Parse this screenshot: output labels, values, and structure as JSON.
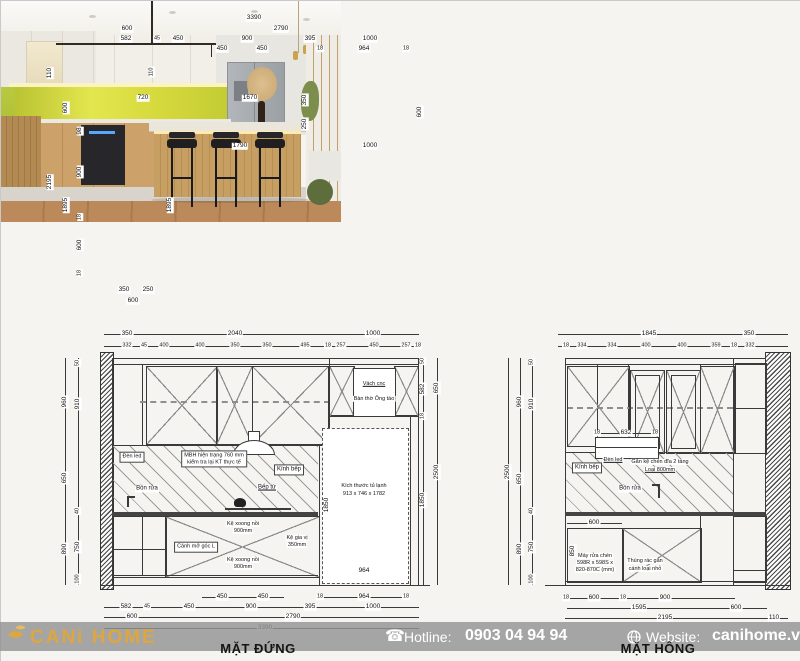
{
  "plan": {
    "top1": [
      "3390"
    ],
    "top2": [
      "600",
      "2790"
    ],
    "top3": [
      "582",
      "45",
      "450",
      "900",
      "395",
      "1000"
    ],
    "top4": [
      "450",
      "450",
      "18",
      "964",
      "18"
    ],
    "left1": [
      "110",
      "2195"
    ],
    "left2": [
      "600",
      "1895"
    ],
    "left3": [
      "98",
      "900",
      "18",
      "600",
      "18"
    ],
    "inner": [
      "720",
      "110",
      "1670",
      "350",
      "250",
      "1790",
      "1000",
      "1895",
      "600"
    ],
    "bottom": [
      "350",
      "250",
      "600"
    ]
  },
  "notes": {
    "title": "KHÁCH BẾP",
    "heading": "GHI CHÚ :",
    "bullet": "-",
    "note1": "Kiểm tra kích thước thực tế trước khi thi công",
    "note2": "Kết hợp xem ảnh thực tế và bản vẽ sản xuất",
    "subtitle": "CHI TIẾT BẾP L + TỦ LẠNH"
  },
  "front": {
    "title": "MẶT ĐỨNG",
    "top1": [
      "350",
      "2040",
      "1000"
    ],
    "top2": [
      "332",
      "45",
      "400",
      "400",
      "350",
      "350",
      "495",
      "18",
      "257",
      "450",
      "257",
      "18"
    ],
    "left1": [
      "960",
      "650",
      "890"
    ],
    "left2": [
      "50",
      "910",
      "40",
      "750",
      "100"
    ],
    "right1": [
      "50",
      "582",
      "18",
      "1850"
    ],
    "right2": [
      "650",
      "2500"
    ],
    "bottom1": [
      "450",
      "450",
      "18",
      "964",
      "18"
    ],
    "bottom2": [
      "582",
      "45",
      "450",
      "900",
      "395",
      "1000"
    ],
    "bottom3": [
      "600",
      "2790"
    ],
    "bottom4": [
      "3390"
    ],
    "labels": {
      "vach": "Vách cnc",
      "bantho": "Bàn thờ Ông táo",
      "denled": "Đèn led",
      "mbh1": "MBH hiện trạng 760 mm",
      "mbh2": "kiểm tra lại KT thực tế",
      "kinhbep": "Kính bếp",
      "beptu": "Bếp từ",
      "bonrua": "Bồn rửa",
      "canhmo": "Cánh mở góc L",
      "kexoong1": "Kệ xoong nồi",
      "kexoong2": "900mm",
      "kegiavi1": "Kệ gia vị",
      "kegiavi2": "350mm",
      "tulanh1": "Kích thước tủ lạnh",
      "tulanh2": "913 x 746 x 1782",
      "d1850": "1850",
      "d964": "964"
    }
  },
  "side": {
    "title": "MẶT HÔNG",
    "top1": [
      "1845",
      "350"
    ],
    "top2": [
      "18",
      "334",
      "334",
      "400",
      "400",
      "359",
      "18",
      "332"
    ],
    "left1": [
      "2500"
    ],
    "left2": [
      "960",
      "650",
      "890"
    ],
    "left3": [
      "50",
      "910",
      "40",
      "750",
      "100"
    ],
    "shelf": [
      "18",
      "632",
      "18"
    ],
    "bottom1": [
      "18",
      "600",
      "18",
      "900"
    ],
    "bottom2": [
      "1595",
      "600"
    ],
    "bottom3": [
      "2195",
      "110"
    ],
    "labels": {
      "kinhbep": "Kính bếp",
      "denled": "Đèn led",
      "kechen1": "Gắn kệ chén đĩa 2 tầng",
      "kechen2": "Loại 800mm",
      "bonrua": "Bồn rửa",
      "d600": "600",
      "d850": "850",
      "mayrua1": "Máy rửa chén",
      "mayrua2": "598R x 598S x",
      "mayrua3": "820-870C (mm)",
      "thungrac1": "Thùng rác gắn",
      "thungrac2": "cánh loại nhỏ"
    }
  },
  "footer": {
    "brand": "CANi HOME",
    "phone_icon": "☎",
    "hotline_label": "Hotline:",
    "hotline_number": "0903 04 94 94",
    "website_label": "Website:",
    "website_url": "canihome.vn"
  },
  "colors": {
    "accent_gold": "#DDA63F",
    "footer_band": "#949494",
    "backsplash_green": "#d6d93c",
    "cabinet_wood": "#c29160"
  }
}
